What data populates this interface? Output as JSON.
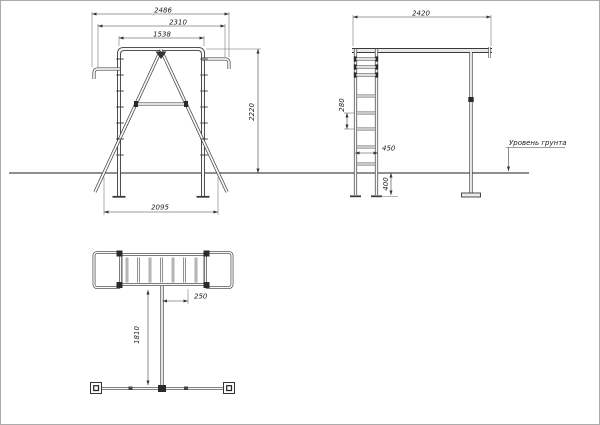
{
  "views": {
    "front": {
      "dim_overall_width": "2486",
      "dim_inner_width": "2310",
      "dim_top_bar": "1538",
      "dim_height": "2220",
      "dim_leg_span": "2095"
    },
    "side": {
      "dim_depth": "2420",
      "dim_rung_spacing": "280",
      "dim_ladder_width": "450",
      "dim_below_ground": "400",
      "ground_label": "Уровень грунта"
    },
    "top": {
      "dim_post_offset": "250",
      "dim_outrigger_length": "1810"
    }
  }
}
